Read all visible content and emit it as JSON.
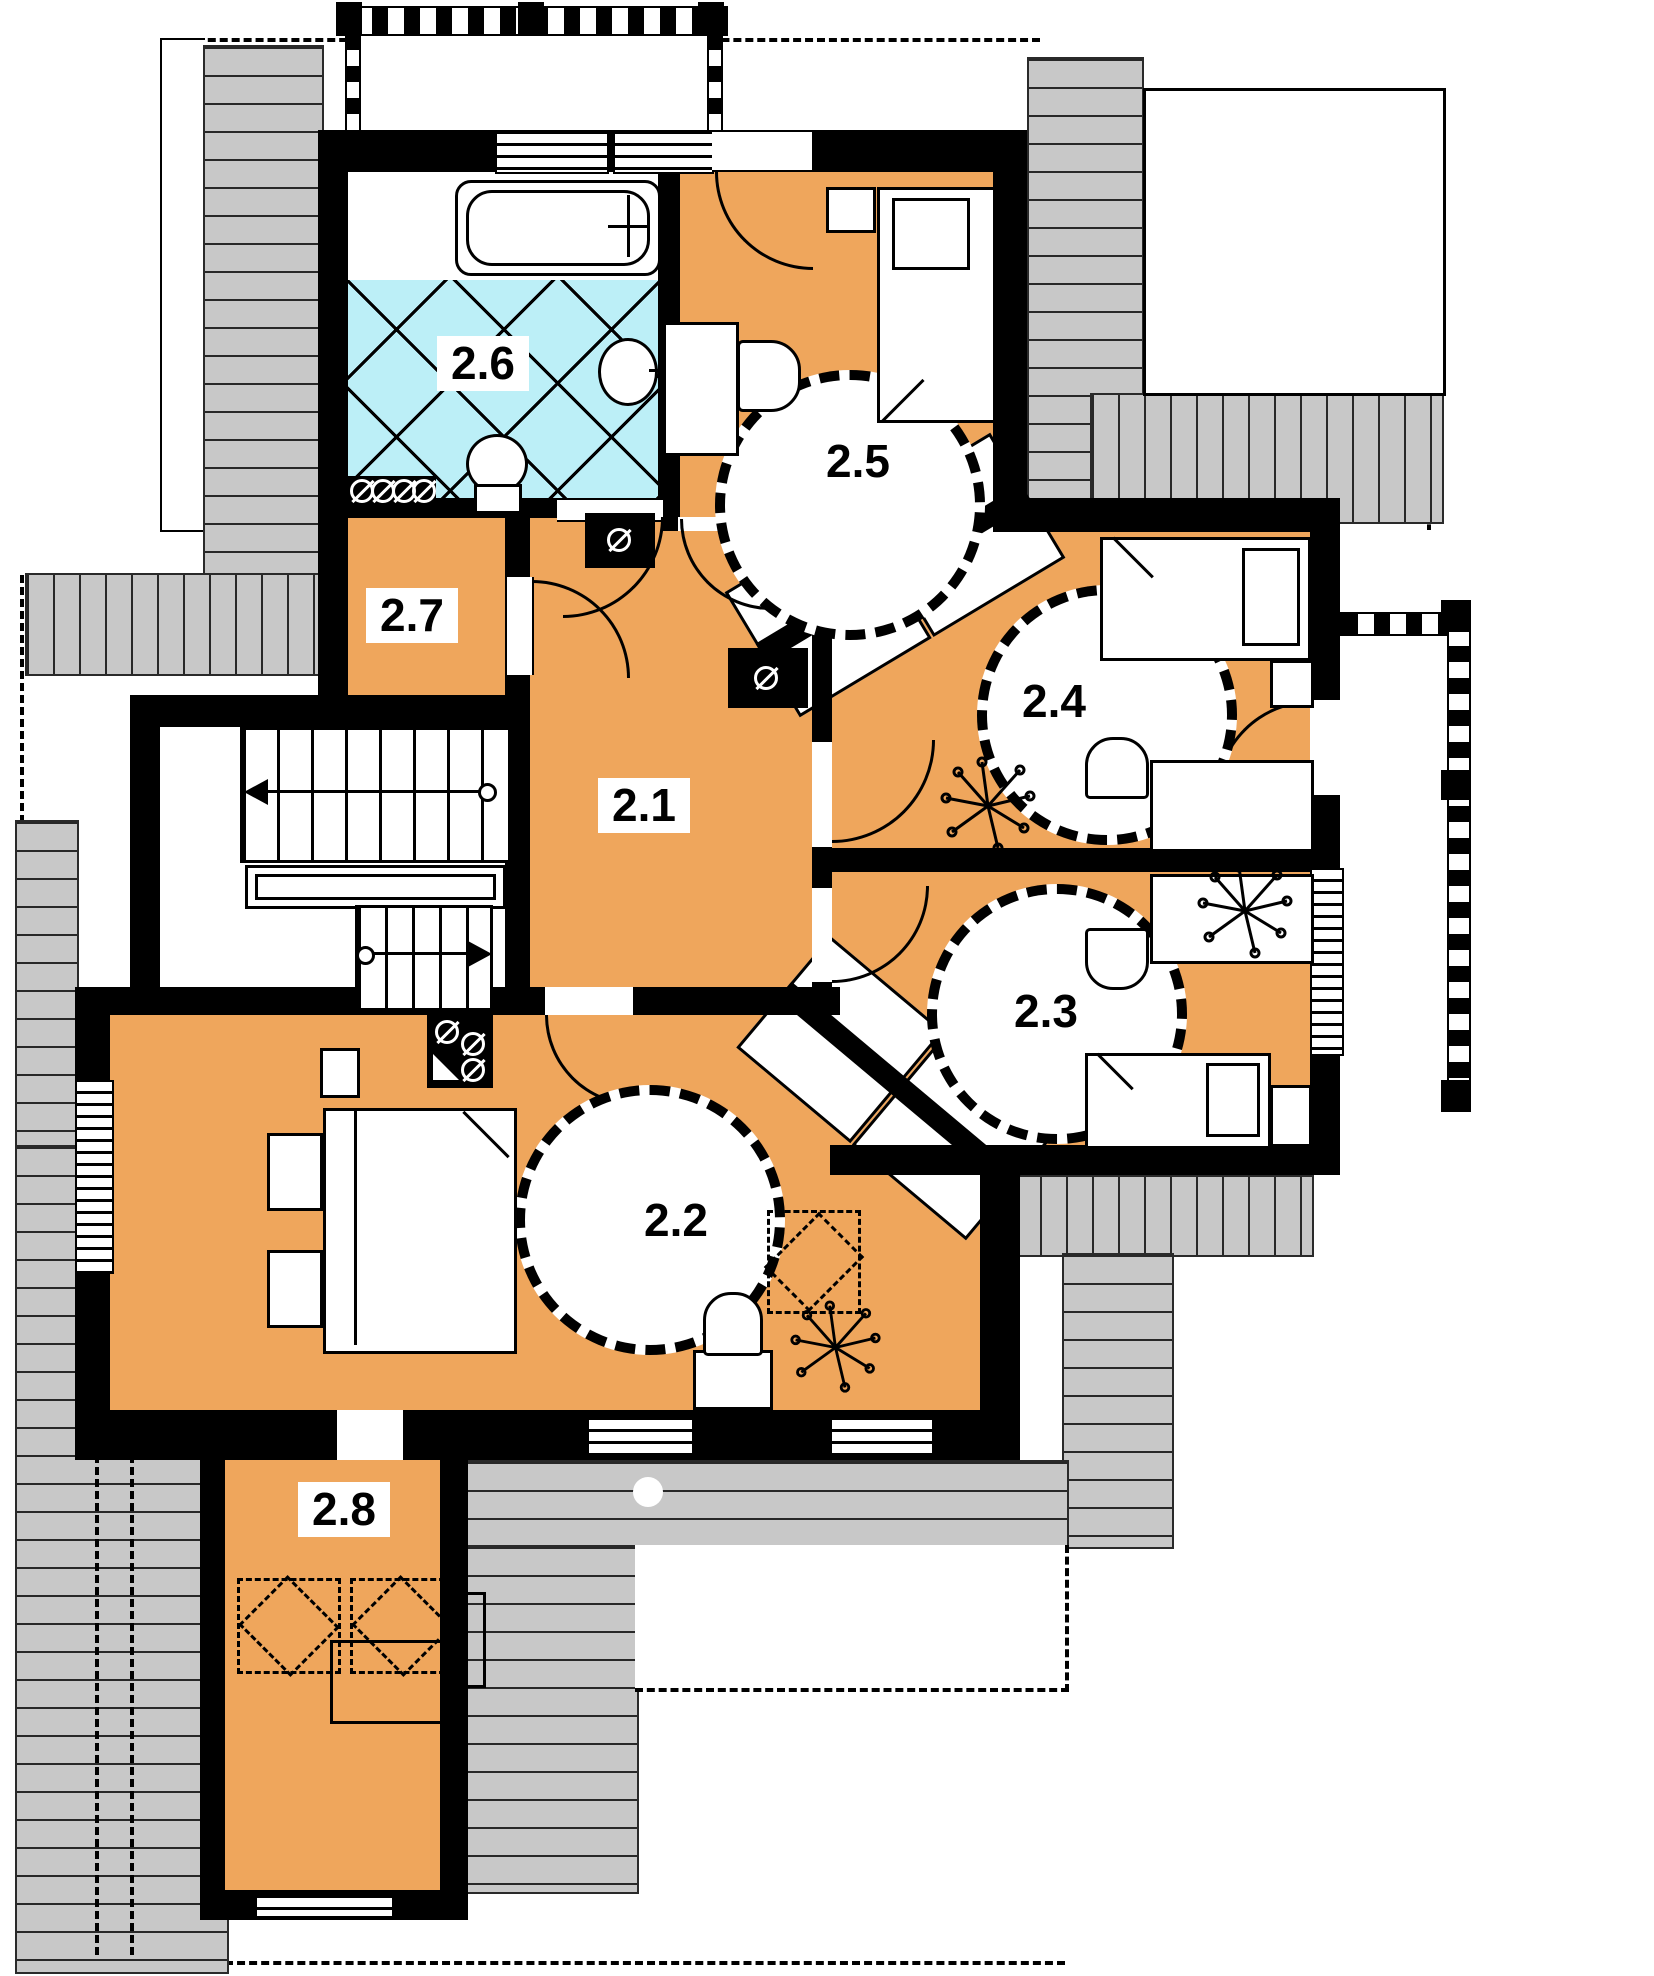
{
  "title": "Upper floor (attic) architectural floor plan",
  "rooms": [
    {
      "id": "room-2-1",
      "label": "2.1"
    },
    {
      "id": "room-2-2",
      "label": "2.2"
    },
    {
      "id": "room-2-3",
      "label": "2.3"
    },
    {
      "id": "room-2-4",
      "label": "2.4"
    },
    {
      "id": "room-2-5",
      "label": "2.5"
    },
    {
      "id": "room-2-6",
      "label": "2.6"
    },
    {
      "id": "room-2-7",
      "label": "2.7"
    },
    {
      "id": "room-2-8",
      "label": "2.8"
    }
  ],
  "colors": {
    "floor": "#EFA65C",
    "bathroom_tile": "#BCEFF7",
    "roof": "#C8C8C8",
    "wall": "#000000",
    "background": "#FFFFFF"
  }
}
